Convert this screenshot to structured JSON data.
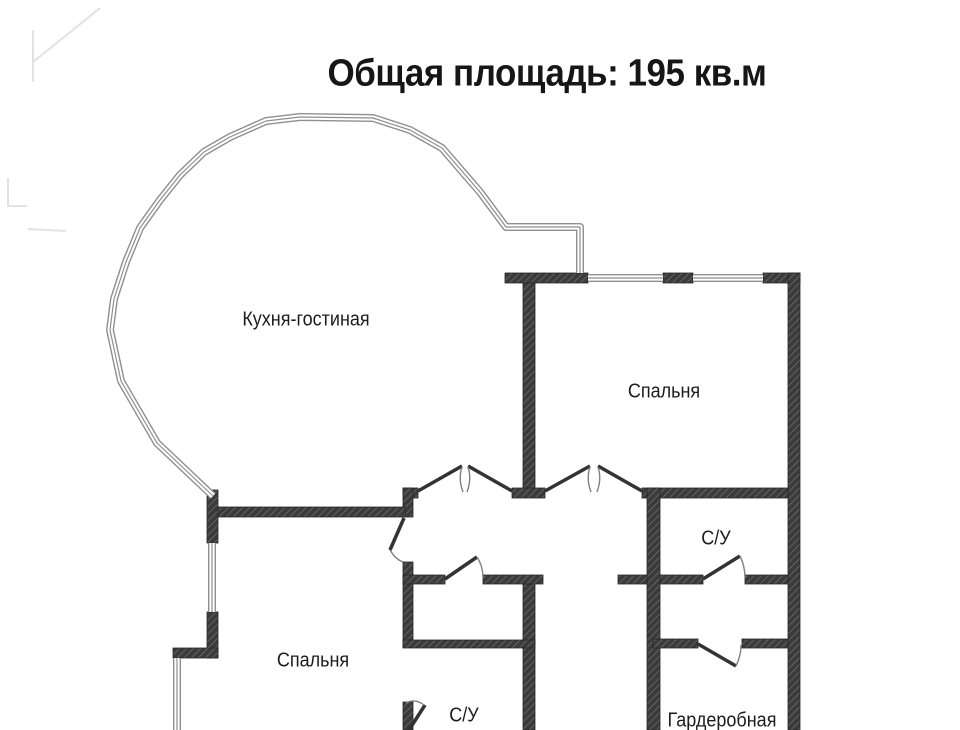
{
  "title": "Общая площадь: 195 кв.м",
  "rooms": [
    {
      "id": "kitchen-living",
      "label": "Кухня-гостиная"
    },
    {
      "id": "bedroom-top-right",
      "label": "Спальня"
    },
    {
      "id": "bathroom-right",
      "label": "С/У"
    },
    {
      "id": "bedroom-bottom-left",
      "label": "Спальня"
    },
    {
      "id": "bathroom-bottom",
      "label": "С/У"
    },
    {
      "id": "wardrobe",
      "label": "Гардеробная"
    }
  ],
  "colors": {
    "wall": "#3b3b3b",
    "wall_hatch": "#6e6e6e",
    "window_line": "#8f8f8f",
    "door_leaf": "#333333",
    "door_arc": "#808080",
    "text": "#1c1c1c",
    "background": "#ffffff"
  }
}
